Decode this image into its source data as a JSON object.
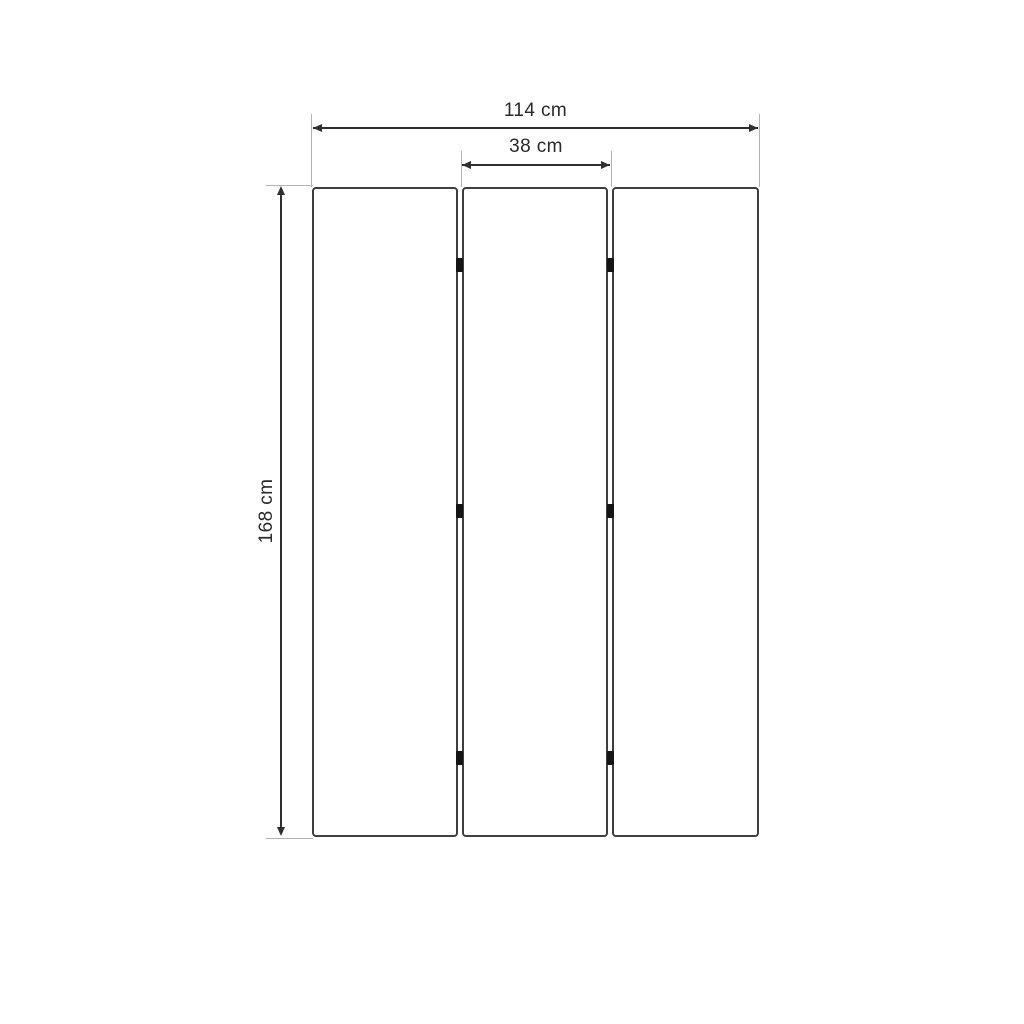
{
  "drawing": {
    "dimensions": {
      "total_width": {
        "label": "114 cm",
        "value": 114,
        "unit": "cm"
      },
      "panel_width": {
        "label": "38 cm",
        "value": 38,
        "unit": "cm"
      },
      "height": {
        "label": "168 cm",
        "value": 168,
        "unit": "cm"
      }
    },
    "panel_count": 3,
    "hinge_rows_per_gap": 3,
    "colors": {
      "background": "#ffffff",
      "panel_border": "#3e3e3e",
      "dimension_line": "#2f2f2f",
      "extension_line": "#b4b4b4",
      "hinge": "#151515",
      "label_text": "#2a2a2a"
    }
  }
}
